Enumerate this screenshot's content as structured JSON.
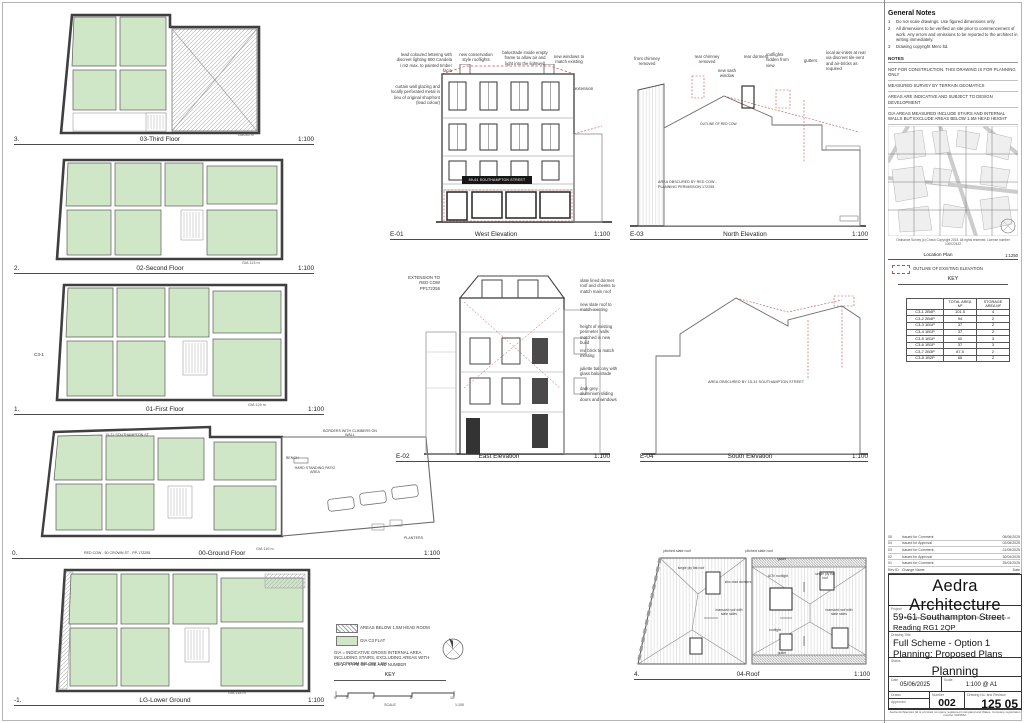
{
  "plans": {
    "third": {
      "num": "3.",
      "name": "03-Third Floor",
      "gia": "GIA 85 m",
      "scale": "1:100"
    },
    "second": {
      "num": "2.",
      "name": "02-Second Floor",
      "gia": "GIA 113 m",
      "scale": "1:100"
    },
    "first": {
      "num": "1.",
      "name": "01-First Floor",
      "gia": "GIA 129 m",
      "scale": "1:100",
      "tag": "C3-1"
    },
    "ground": {
      "num": "0.",
      "name": "00-Ground Floor",
      "gia": "GIA 116 m",
      "scale": "1:100",
      "street": "15-31 SOUTHAMPTON ST",
      "borders": "BORDERS WITH CLIMBERS ON WALL",
      "bench": "BENCH",
      "patio": "HARD STANDING PATIO AREA",
      "planters": "PLANTERS",
      "note": "RED COW - 50 CROWN ST - PP-172255"
    },
    "lower": {
      "num": "-1.",
      "name": "LG-Lower Ground",
      "gia": "GIA 118 m",
      "scale": "1:100"
    },
    "roof": {
      "num": "4.",
      "name": "04-Roof",
      "scale": "1:100",
      "pitched_left": "pitched slate roof",
      "pitched_right": "pitched slate roof",
      "flat_left": "single ply flat roof",
      "flat_right": "single ply flat roof",
      "dormers": "zinc clad dormers",
      "aov": "AOV rooflight",
      "rooflight": "rooflight",
      "mansard_left": "mansard roof with slate sides",
      "mansard_right": "mansard roof with slate sides",
      "gutter_top": "gutter",
      "gutter_bottom": "gutter"
    }
  },
  "elevations": {
    "west": {
      "id": "E-01",
      "name": "West Elevation",
      "scale": "1:100",
      "sign": "59-61 SOUTHAMPTON STREET",
      "a1": "lead coloured lettering with discreet lighting 800 Candela / m2 max. to painted timber facia",
      "a2": "new conservation style rooflights",
      "a3": "balustrade inside empty frame to allow air and light into the lightwell",
      "a4": "new windows to match existing",
      "a5": "curtain wall glazing and locally perforated metal in lieu of original shopfront (lead colour)",
      "a6": "rear extension roof"
    },
    "north": {
      "id": "E-03",
      "name": "North Elevation",
      "scale": "1:100",
      "a1": "front chimney removed",
      "a2": "rear chimney removed",
      "a3": "new sash window",
      "a4": "rear dormers",
      "a5": "rooflights hidden from view",
      "a6": "gutters",
      "a7": "local air-inlets at rear via discreet tile-vent and air-bricks as required",
      "outline": "OUTLINE OF RED COW",
      "obscured": "AREA OBSCURED BY RED COW - PLANNING PERMISSION 172255"
    },
    "east": {
      "id": "E-02",
      "name": "East Elevation",
      "scale": "1:100",
      "left": "EXTENSION TO RED COW PP172255",
      "a1": "slate lined dormer roof and cheeks to match main roof",
      "a2": "new slate roof to match existing",
      "a3": "height of existing perimeter walls matched in new build",
      "a4": "red brick to match existing",
      "a5": "juliette balcony with glass balustrade",
      "a6": "dark grey aluminium sliding doors and windows"
    },
    "south": {
      "id": "E-04",
      "name": "South Elevation",
      "scale": "1:100",
      "obscured": "AREA OBSCURED BY 15-31 SOUTHAMPTON STREET"
    }
  },
  "key": {
    "hatch_label": "AREAS BELOW 1.5M HEAD ROOM",
    "green_label": "GIA C3 FLAT",
    "gia_note": "GIA = INDICATIVE GROSS INTERNAL AREA INCLUDING STAIRS, EXCLUDING AREAS WITH HEADROOM BELOW 1.5M",
    "c3_note": "C3-1 = TYPE OF USE AND NUMBER",
    "title": "KEY",
    "scale_ticks": [
      "0",
      "1",
      "3",
      "6",
      "10"
    ],
    "scale_label": "SCALE",
    "scale_ratio": "1:100"
  },
  "general_notes": {
    "title": "General Notes",
    "items": [
      {
        "n": "1",
        "text": "Do not scale drawings. Use figured dimensions only."
      },
      {
        "n": "2",
        "text": "All dimensions to be verified on site prior to commencement of work. Any errors and omissions to be reported to the architect in writing immediately."
      },
      {
        "n": "3",
        "text": "Drawing copyright Mero ltd."
      }
    ],
    "notes_title": "NOTES",
    "notes": [
      "NOT FOR CONSTRUCTION. THIS DRAWING IS FOR PLANNING ONLY",
      "MEASURED SURVEY BY TERRAIN GEOMATICS",
      "AREAS ARE INDICATIVE AND SUBJECT TO DESIGN DEVELOPMENT",
      "GIA AREAS MEASURED INCLUDE STAIRS AND INTERNAL WALLS BUT EXCLUDE AREAS BELOW 1.5M HEAD HEIGHT"
    ]
  },
  "location": {
    "copyright": "Ordnance Survey (c) Crown Copyright 2015. All rights reserved. License number 100022432",
    "label": "Location Plan",
    "scale": "1:1250"
  },
  "elev_key": {
    "item": "OUTLINE OF EXISTING ELEVATION",
    "title": "KEY"
  },
  "area_table": {
    "h1": "TOTAL AREA M²",
    "h2": "STORAGE AREA M²",
    "rows": [
      {
        "unit": "C3-1 2B4P",
        "total": "101.5",
        "storage": "4"
      },
      {
        "unit": "C3-2 2B4P",
        "total": "94",
        "storage": "2"
      },
      {
        "unit": "C3-3 1B1P",
        "total": "37",
        "storage": "2"
      },
      {
        "unit": "C3-4 1B1P",
        "total": "37",
        "storage": "2"
      },
      {
        "unit": "C3-5 1B1P",
        "total": "40",
        "storage": "3"
      },
      {
        "unit": "C3-6 1B1P",
        "total": "37",
        "storage": "3"
      },
      {
        "unit": "C3-7 2B3P",
        "total": "87.5",
        "storage": "2"
      },
      {
        "unit": "C3-8 1B2P",
        "total": "66",
        "storage": "2"
      }
    ]
  },
  "revisions": {
    "rows": [
      {
        "id": "05",
        "name": "Issued for Comment",
        "date": "05/06/2025"
      },
      {
        "id": "04",
        "name": "Issued for Approval",
        "date": "02/06/2025"
      },
      {
        "id": "03",
        "name": "Issued for Comment",
        "date": "21/05/2025"
      },
      {
        "id": "02",
        "name": "Issued for Approval",
        "date": "30/04/2025"
      },
      {
        "id": "01",
        "name": "Issued for Comment",
        "date": "25/03/2025"
      },
      {
        "id": "Rev ID",
        "name": "Change Name",
        "date": "Date"
      }
    ]
  },
  "title_block": {
    "practice": "Aedra Architecture",
    "contact": "11 South Street | Cambridge | CB4 0DS | 07892 98 099 | xxxx@aedra.co.uk",
    "project_label": "Project",
    "project1": "59-61 Southampton Street",
    "project2": "Reading RG1 2QP",
    "title_label": "Drawing Title",
    "title1": "Full Scheme - Option 1",
    "title2": "Planning: Proposed Plans",
    "status_label": "Status",
    "status": "Planning",
    "date_label": "Date",
    "date": "05/06/2025",
    "scale_label": "Scale",
    "scale": "1:100 @ A1",
    "drawn_label": "Drawn",
    "approved_label": "Approved",
    "number_label": "Number",
    "number": "002",
    "drawing_no_label": "Drawing No. and Revision",
    "drawing_no": "125 05",
    "company_note": "Aedra Architecture ltd is a limited company registered in England and Wales. Company registration number 9403652."
  }
}
